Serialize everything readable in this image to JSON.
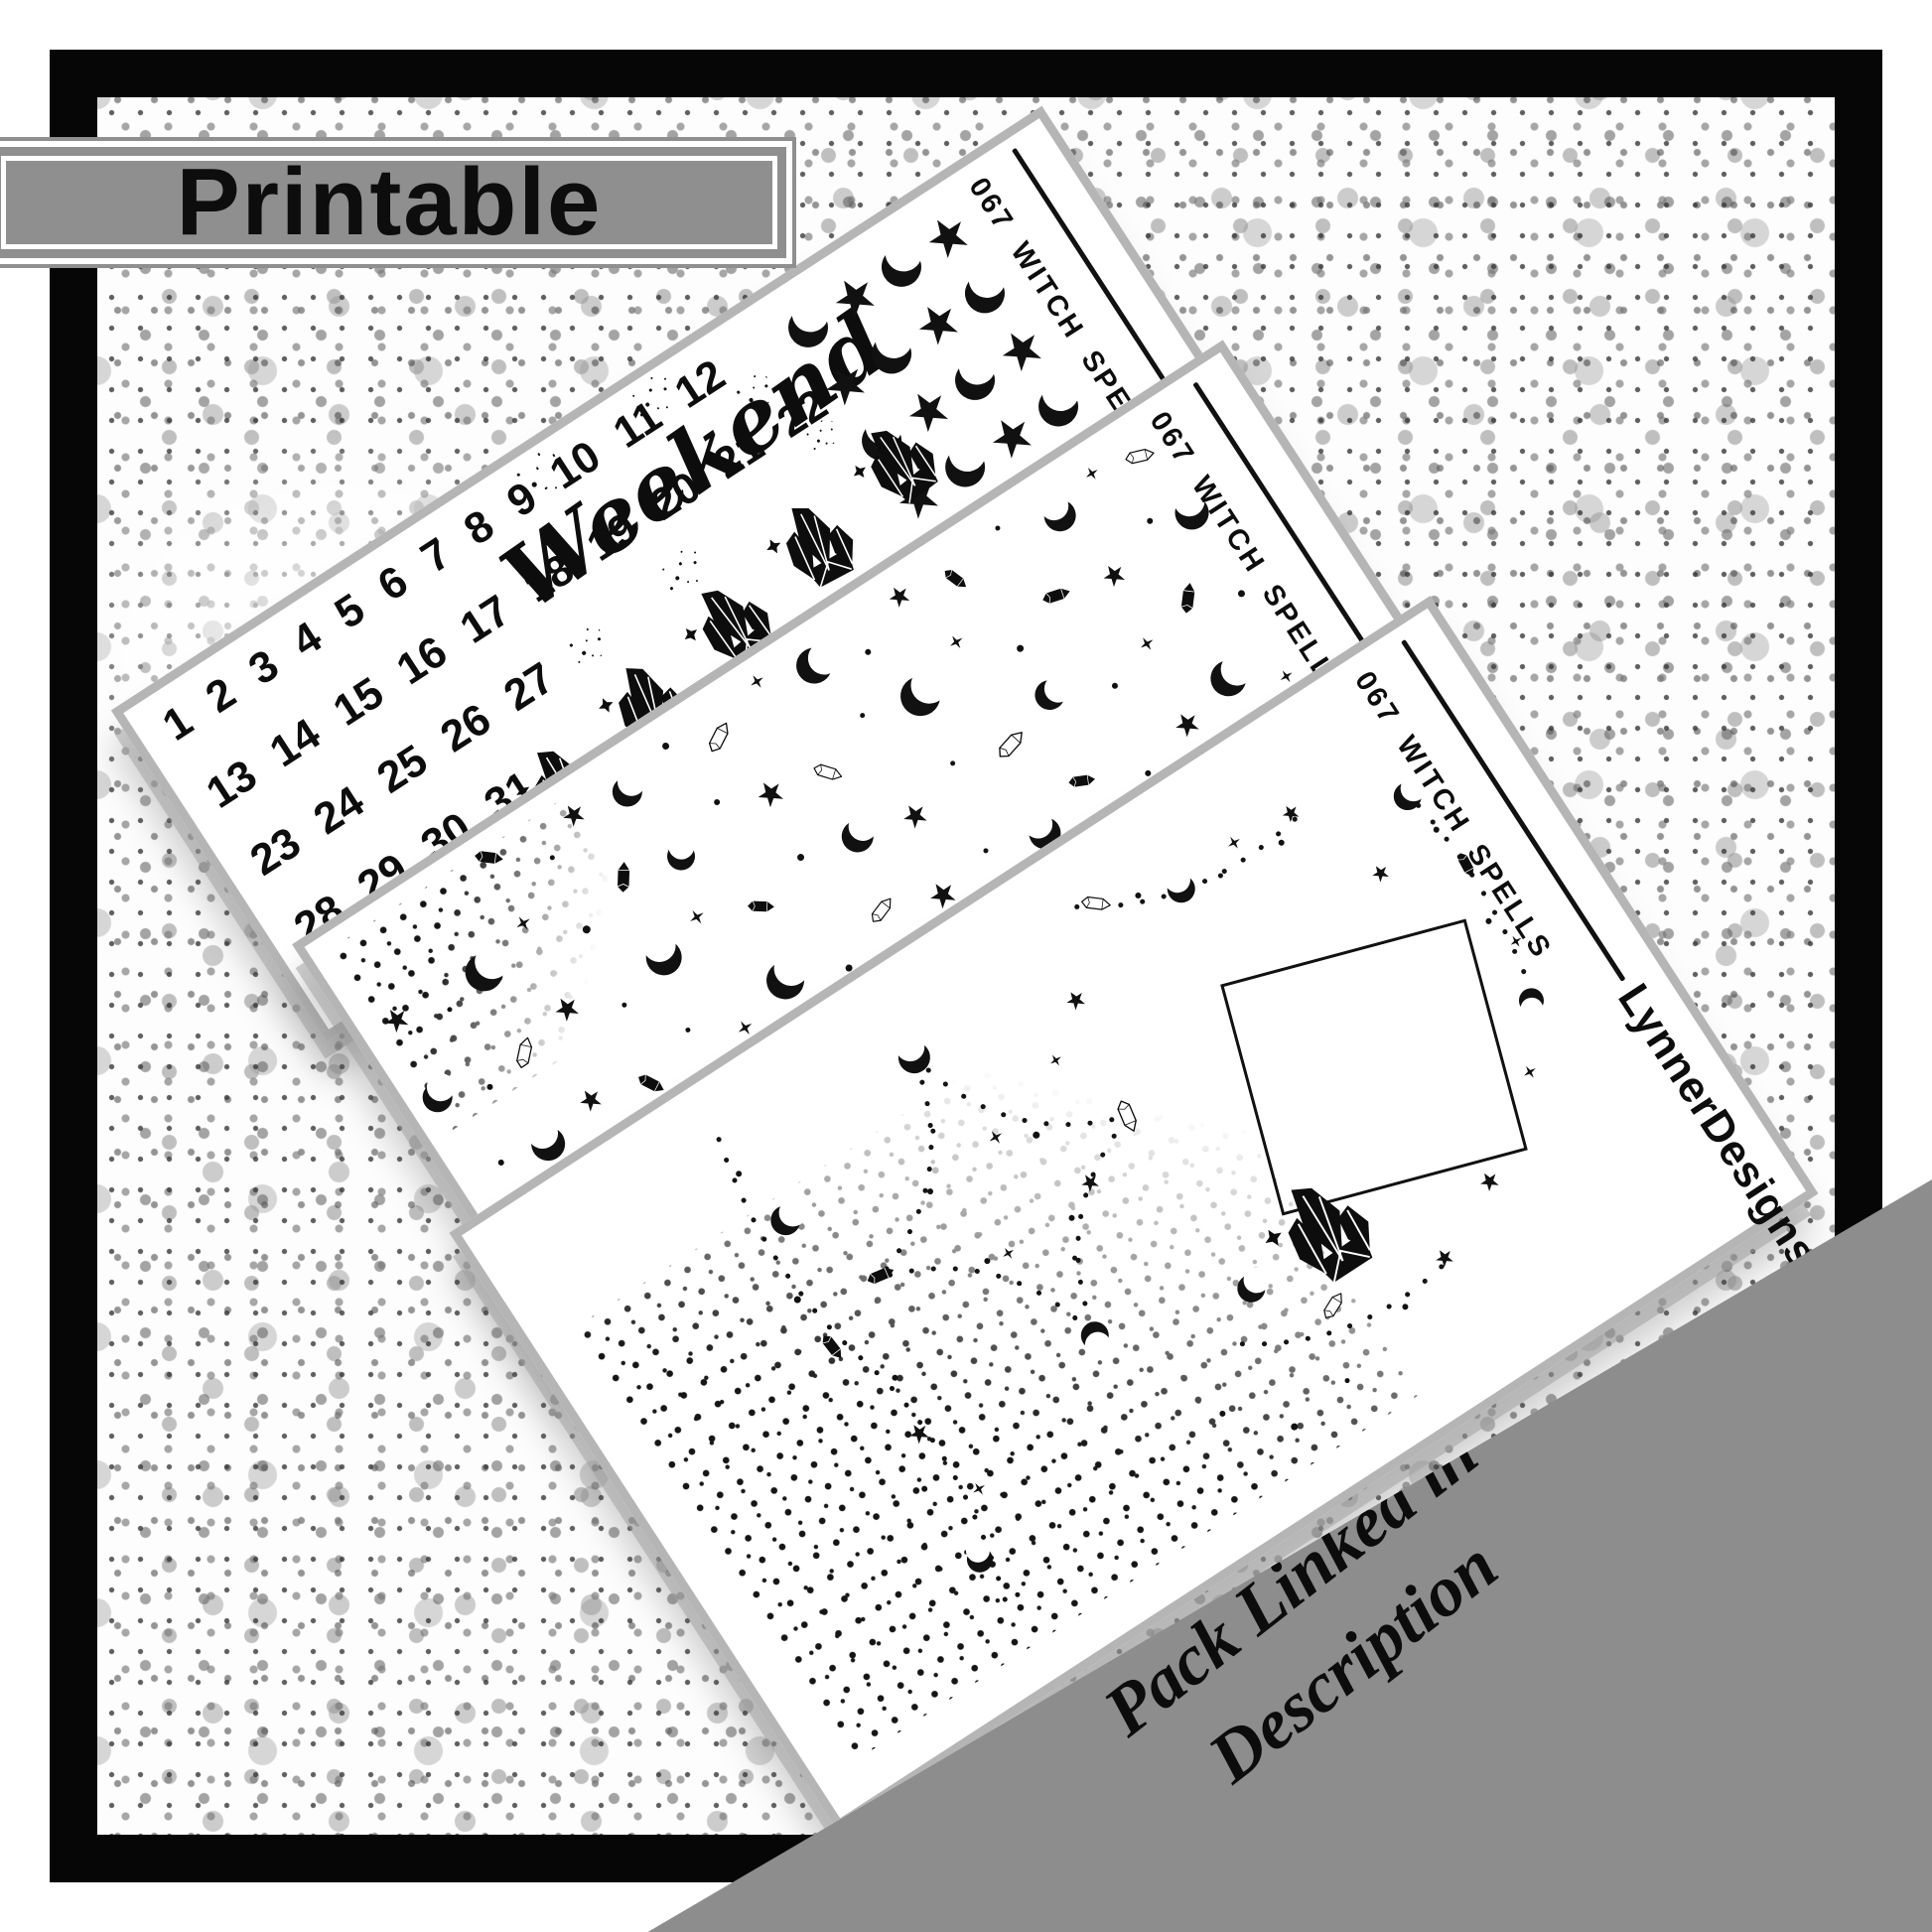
{
  "banner": {
    "label": "Printable"
  },
  "corner_banner": {
    "line1": "Matching Foil",
    "line2": "Pack Linked in",
    "line3": "Description"
  },
  "colors": {
    "banner_gray": "#8f8f8f",
    "corner_banner_gray": "#8d8d8d",
    "frame_black": "#060606",
    "sheet_edge_gray": "#b5b5b5",
    "ink": "#0d0d0d"
  },
  "sheet1": {
    "code": "067 WITCH SPELLS",
    "script_label": "Weekend",
    "date_rows": [
      "1 2 3 4 5 6 7 8 9 10 11 12",
      "13 14 15 16 17 18 19 20 21 22",
      "23 24 25 26 27",
      "28 29 30 31"
    ],
    "checkerboard": [
      "MSMS",
      "SMSM",
      "MSMS",
      "SMSM",
      "MSMS"
    ],
    "scatter": [
      [
        330,
        302,
        "cluster",
        92,
        0
      ],
      [
        445,
        280,
        "cluster",
        95,
        8
      ],
      [
        560,
        258,
        "cluster",
        95,
        -6
      ],
      [
        675,
        236,
        "cluster",
        95,
        5
      ],
      [
        790,
        214,
        "cluster",
        90,
        -4
      ],
      [
        470,
        30,
        "dots",
        0.9,
        0
      ],
      [
        610,
        25,
        "dots",
        0.8,
        0
      ],
      [
        700,
        78,
        "dots",
        0.7,
        0
      ],
      [
        420,
        200,
        "dots",
        0.7,
        0
      ],
      [
        540,
        188,
        "dots",
        0.8,
        0
      ],
      [
        735,
        150,
        "dots",
        0.6,
        0
      ],
      [
        640,
        330,
        "dots",
        0.7,
        0
      ],
      [
        505,
        345,
        "dots",
        0.6,
        0
      ]
    ]
  },
  "sheet2": {
    "code": "067 WITCH SPELLS",
    "scatter": [
      [
        205,
        26,
        "gemf",
        30,
        40
      ],
      [
        258,
        60,
        "dot",
        5,
        0
      ],
      [
        300,
        36,
        "star",
        22,
        0
      ],
      [
        358,
        46,
        "moon",
        30,
        15
      ],
      [
        415,
        28,
        "dot",
        7,
        0
      ],
      [
        465,
        50,
        "gemo",
        33,
        -30
      ],
      [
        528,
        24,
        "spark",
        15,
        0
      ],
      [
        585,
        42,
        "moon",
        36,
        45
      ],
      [
        638,
        60,
        "dot",
        6,
        0
      ],
      [
        695,
        30,
        "star",
        21,
        0
      ],
      [
        752,
        46,
        "gemf",
        28,
        70
      ],
      [
        815,
        26,
        "dot",
        5,
        0
      ],
      [
        875,
        50,
        "moon",
        32,
        -40
      ],
      [
        925,
        32,
        "spark",
        14,
        0
      ],
      [
        975,
        44,
        "gemo",
        30,
        20
      ],
      [
        38,
        112,
        "star",
        24,
        0
      ],
      [
        88,
        132,
        "dot",
        5,
        0
      ],
      [
        138,
        120,
        "moon",
        38,
        25
      ],
      [
        198,
        100,
        "spark",
        16,
        0
      ],
      [
        248,
        140,
        "dot",
        8,
        0
      ],
      [
        308,
        116,
        "gemf",
        32,
        -55
      ],
      [
        368,
        130,
        "moon",
        28,
        -10
      ],
      [
        428,
        104,
        "dot",
        6,
        0
      ],
      [
        478,
        126,
        "star",
        26,
        0
      ],
      [
        538,
        140,
        "gemo",
        30,
        50
      ],
      [
        598,
        110,
        "dot",
        5,
        0
      ],
      [
        658,
        126,
        "moon",
        40,
        30
      ],
      [
        718,
        100,
        "spark",
        15,
        0
      ],
      [
        768,
        140,
        "dot",
        7,
        0
      ],
      [
        828,
        116,
        "gemf",
        30,
        15
      ],
      [
        888,
        130,
        "star",
        22,
        0
      ],
      [
        948,
        104,
        "dot",
        6,
        0
      ],
      [
        988,
        120,
        "moon",
        34,
        -25
      ],
      [
        30,
        200,
        "moon",
        30,
        10
      ],
      [
        80,
        220,
        "dot",
        6,
        0
      ],
      [
        128,
        210,
        "gemo",
        32,
        -45
      ],
      [
        188,
        196,
        "star",
        24,
        0
      ],
      [
        238,
        224,
        "dot",
        5,
        0
      ],
      [
        298,
        206,
        "moon",
        36,
        -30
      ],
      [
        348,
        190,
        "spark",
        16,
        0
      ],
      [
        408,
        216,
        "gemf",
        28,
        35
      ],
      [
        468,
        196,
        "dot",
        7,
        0
      ],
      [
        528,
        210,
        "moon",
        32,
        20
      ],
      [
        588,
        224,
        "star",
        24,
        0
      ],
      [
        648,
        200,
        "dot",
        5,
        0
      ],
      [
        708,
        216,
        "gemo",
        34,
        -15
      ],
      [
        768,
        196,
        "moon",
        30,
        45
      ],
      [
        828,
        224,
        "dot",
        6,
        0
      ],
      [
        878,
        206,
        "spark",
        15,
        0
      ],
      [
        938,
        190,
        "gemf",
        32,
        -50
      ],
      [
        985,
        215,
        "dot",
        7,
        0
      ],
      [
        48,
        290,
        "dot",
        6,
        0
      ],
      [
        98,
        300,
        "moon",
        34,
        -40
      ],
      [
        158,
        286,
        "star",
        22,
        0
      ],
      [
        218,
        306,
        "gemf",
        30,
        60
      ],
      [
        278,
        280,
        "dot",
        5,
        0
      ],
      [
        328,
        310,
        "spark",
        16,
        0
      ],
      [
        388,
        292,
        "moon",
        38,
        15
      ],
      [
        448,
        316,
        "dot",
        7,
        0
      ],
      [
        508,
        286,
        "gemo",
        30,
        -20
      ],
      [
        568,
        306,
        "star",
        26,
        0
      ],
      [
        628,
        292,
        "dot",
        5,
        0
      ],
      [
        688,
        310,
        "moon",
        32,
        -45
      ],
      [
        748,
        286,
        "gemf",
        28,
        25
      ],
      [
        808,
        316,
        "dot",
        6,
        0
      ],
      [
        868,
        296,
        "star",
        24,
        0
      ],
      [
        928,
        280,
        "moon",
        36,
        35
      ],
      [
        978,
        310,
        "spark",
        14,
        0
      ],
      [
        68,
        370,
        "moon",
        30,
        20
      ],
      [
        128,
        386,
        "dot",
        5,
        0
      ],
      [
        178,
        366,
        "gemo",
        32,
        30
      ],
      [
        238,
        390,
        "spark",
        15,
        0
      ],
      [
        298,
        370,
        "star",
        22,
        0
      ],
      [
        358,
        386,
        "dot",
        7,
        0
      ],
      [
        418,
        366,
        "moon",
        34,
        -25
      ],
      [
        478,
        390,
        "gemf",
        30,
        -70
      ],
      [
        538,
        370,
        "dot",
        5,
        0
      ],
      [
        598,
        386,
        "star",
        24,
        0
      ],
      [
        658,
        366,
        "moon",
        38,
        10
      ],
      [
        718,
        390,
        "dot",
        6,
        0
      ],
      [
        778,
        370,
        "gemo",
        30,
        40
      ],
      [
        838,
        386,
        "spark",
        16,
        0
      ],
      [
        898,
        366,
        "dot",
        7,
        0
      ],
      [
        958,
        390,
        "moon",
        32,
        -15
      ],
      [
        78,
        445,
        "moon",
        30,
        -20
      ],
      [
        148,
        462,
        "dot",
        5,
        0
      ],
      [
        208,
        442,
        "star",
        22,
        0
      ],
      [
        268,
        466,
        "spark",
        14,
        0
      ],
      [
        328,
        446,
        "gemf",
        30,
        45
      ],
      [
        398,
        468,
        "dot",
        6,
        0
      ],
      [
        458,
        448,
        "moon",
        32,
        15
      ],
      [
        528,
        470,
        "star",
        24,
        0
      ],
      [
        598,
        450,
        "dot",
        5,
        0
      ],
      [
        668,
        466,
        "gemo",
        32,
        -35
      ],
      [
        738,
        446,
        "moon",
        30,
        40
      ],
      [
        808,
        470,
        "dot",
        6,
        0
      ],
      [
        868,
        450,
        "spark",
        15,
        0
      ],
      [
        928,
        466,
        "star",
        22,
        0
      ],
      [
        978,
        446,
        "dot",
        6,
        0
      ]
    ]
  },
  "sheet3": {
    "code": "067 WITCH SPELLS",
    "brand": "LynnerDesigns",
    "scatter": [
      [
        480,
        98,
        "moon",
        32,
        -30
      ],
      [
        628,
        264,
        "gemo",
        34,
        100
      ],
      [
        480,
        432,
        "moon",
        28,
        150
      ],
      [
        332,
        264,
        "gemf",
        30,
        10
      ],
      [
        505,
        210,
        "spark",
        15,
        0
      ],
      [
        452,
        315,
        "spark",
        13,
        0
      ],
      [
        560,
        300,
        "star",
        18,
        0
      ],
      [
        420,
        220,
        "dot",
        6,
        0
      ],
      [
        540,
        230,
        "dot",
        7,
        0
      ],
      [
        430,
        310,
        "dot",
        6,
        0
      ],
      [
        525,
        320,
        "dot",
        6,
        0
      ],
      [
        455,
        170,
        "dot",
        5,
        0
      ],
      [
        505,
        355,
        "dot",
        5,
        0
      ],
      [
        282,
        165,
        "moon",
        30,
        35
      ],
      [
        252,
        298,
        "gemf",
        30,
        85
      ],
      [
        278,
        418,
        "star",
        20,
        0
      ],
      [
        298,
        498,
        "spark",
        14,
        0
      ],
      [
        260,
        558,
        "moon",
        26,
        -20
      ],
      [
        268,
        100,
        "dot",
        6,
        0
      ],
      [
        248,
        238,
        "dot",
        7,
        0
      ],
      [
        288,
        358,
        "dot",
        6,
        0
      ],
      [
        252,
        468,
        "dot",
        6,
        0
      ],
      [
        272,
        608,
        "dot",
        5,
        0
      ],
      [
        718,
        68,
        "gemo",
        30,
        40
      ],
      [
        798,
        102,
        "moon",
        28,
        -35
      ],
      [
        868,
        92,
        "spark",
        14,
        0
      ],
      [
        758,
        84,
        "dot",
        6,
        0
      ],
      [
        838,
        112,
        "dot",
        5,
        0
      ],
      [
        908,
        118,
        "dot",
        6,
        0
      ],
      [
        932,
        98,
        "star",
        17,
        0
      ],
      [
        648,
        138,
        "star",
        19,
        0
      ],
      [
        598,
        178,
        "spark",
        13,
        0
      ],
      [
        1040,
        148,
        "moon",
        28,
        25
      ],
      [
        1052,
        238,
        "gemf",
        28,
        95
      ],
      [
        1046,
        192,
        "dot",
        6,
        0
      ],
      [
        1040,
        298,
        "dot",
        6,
        0
      ],
      [
        1052,
        330,
        "spark",
        13,
        0
      ],
      [
        1032,
        388,
        "moon",
        25,
        165
      ],
      [
        975,
        198,
        "star",
        17,
        0
      ],
      [
        992,
        448,
        "spark",
        14,
        0
      ],
      [
        898,
        518,
        "star",
        19,
        0
      ],
      [
        638,
        478,
        "moon",
        28,
        20
      ],
      [
        698,
        538,
        "gemo",
        30,
        -25
      ],
      [
        758,
        578,
        "dot",
        6,
        0
      ],
      [
        818,
        558,
        "star",
        18,
        0
      ],
      [
        598,
        618,
        "dot",
        7,
        0
      ],
      [
        668,
        608,
        "dot",
        5,
        0
      ],
      [
        545,
        568,
        "dot",
        6,
        0
      ],
      [
        728,
        468,
        "cluster",
        115,
        0
      ]
    ]
  }
}
